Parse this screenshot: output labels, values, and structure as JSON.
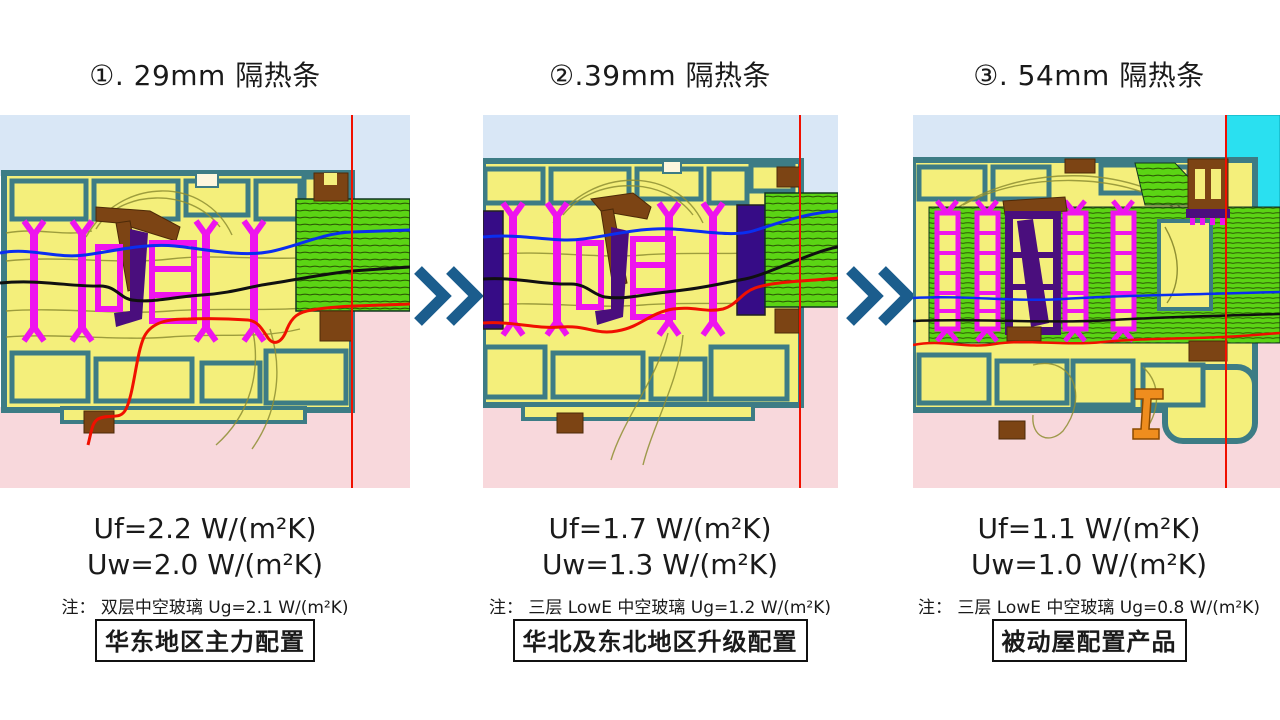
{
  "slide": {
    "kind": "thermal-break-comparison"
  },
  "palette": {
    "bg_blue": "#d9e7f6",
    "bg_pink": "#f8d8dc",
    "frame_yellow": "#f4ef7b",
    "frame_teal": "#3d7c85",
    "magenta": "#ee14ee",
    "purple_dark": "#4a0e7d",
    "indigo": "#360c86",
    "brown": "#7c4414",
    "glass_green": "#5bd414",
    "glass_stripe": "#2d5b05",
    "cyan": "#2ae0f0",
    "orange": "#ef8d1e",
    "iso_red": "#f01000",
    "iso_blue": "#0a2ef0",
    "iso_black": "#101010",
    "contour": "#8f8f33",
    "arrow_blue": "#1b5d8d",
    "text": "#1a1a1a"
  },
  "columns": [
    {
      "title": "①. 29mm 隔热条",
      "uf": "Uf=2.2 W/(m²K)",
      "uw": "Uw=2.0 W/(m²K)",
      "note": "注： 双层中空玻璃 Ug=2.1 W/(m²K)",
      "tag": "华东地区主力配置"
    },
    {
      "title": "②.39mm 隔热条",
      "uf": "Uf=1.7 W/(m²K)",
      "uw": "Uw=1.3 W/(m²K)",
      "note": "注： 三层 LowE 中空玻璃 Ug=1.2 W/(m²K)",
      "tag": "华北及东北地区升级配置"
    },
    {
      "title": "③. 54mm 隔热条",
      "uf": "Uf=1.1 W/(m²K)",
      "uw": "Uw=1.0 W/(m²K)",
      "note": "注： 三层 LowE 中空玻璃 Ug=0.8 W/(m²K)",
      "tag": "被动屋配置产品"
    }
  ]
}
